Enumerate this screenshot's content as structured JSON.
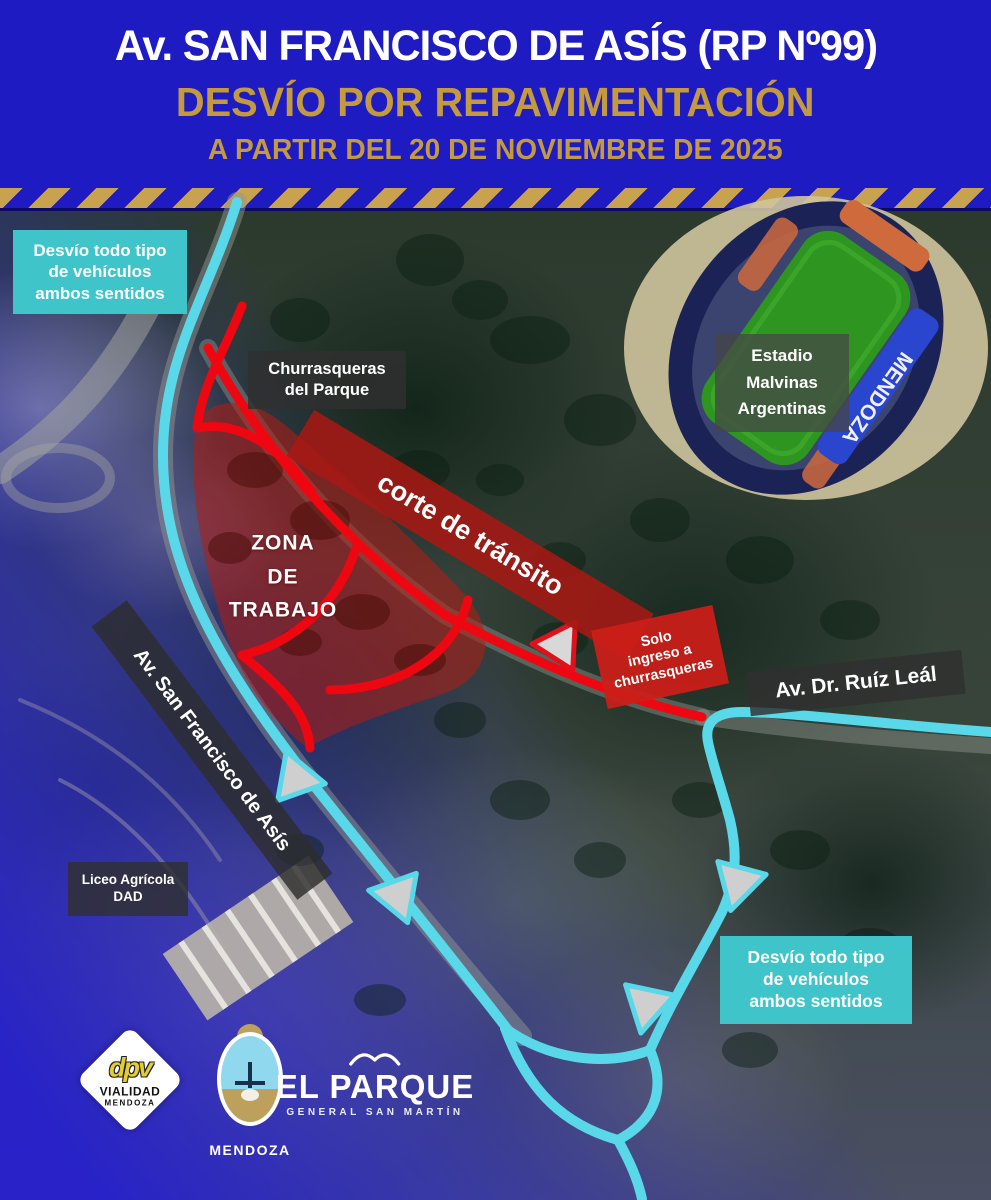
{
  "header": {
    "title": "Av. SAN FRANCISCO DE ASÍS (RP Nº99)",
    "subtitle": "DESVÍO POR REPAVIMENTACIÓN",
    "date_line": "A PARTIR DEL 20 DE NOVIEMBRE DE 2025"
  },
  "map": {
    "detour_note_top": "Desvío todo tipo\nde vehículos\nambos sentidos",
    "detour_note_bottom": "Desvío todo tipo\nde vehículos\nambos sentidos",
    "churrasqueras_label": "Churrasqueras\ndel Parque",
    "stadium_label": "Estadio\nMalvinas\nArgentinas",
    "stadium_seats_text": "MENDOZA",
    "closure_label": "corte de tránsito",
    "entry_only_label": "Solo\ningreso a\nchurrasqueras",
    "ruiz_leal_label": "Av. Dr. Ruíz Leál",
    "san_francisco_label": "Av. San Francisco de Asís",
    "work_zone_label": "ZONA\nDE\nTRABAJO",
    "liceo_label": "Liceo Agrícola\nDAD"
  },
  "logos": {
    "dpv_monogram": "dpv",
    "dpv_line1": "VIALIDAD",
    "dpv_line2": "MENDOZA",
    "mendoza_caption": "MENDOZA",
    "park_name": "EL PARQUE",
    "park_subtitle": "GENERAL SAN MARTÍN"
  },
  "colors": {
    "header_blue": "#1f1bc3",
    "accent_gold": "#c39a40",
    "hazard_gold": "#c8a24e",
    "route_cyan": "#58d8e9",
    "note_teal": "#3fc4c9",
    "closure_red": "#ee0711",
    "label_dark_bg": "rgba(48,48,48,0.82)"
  }
}
